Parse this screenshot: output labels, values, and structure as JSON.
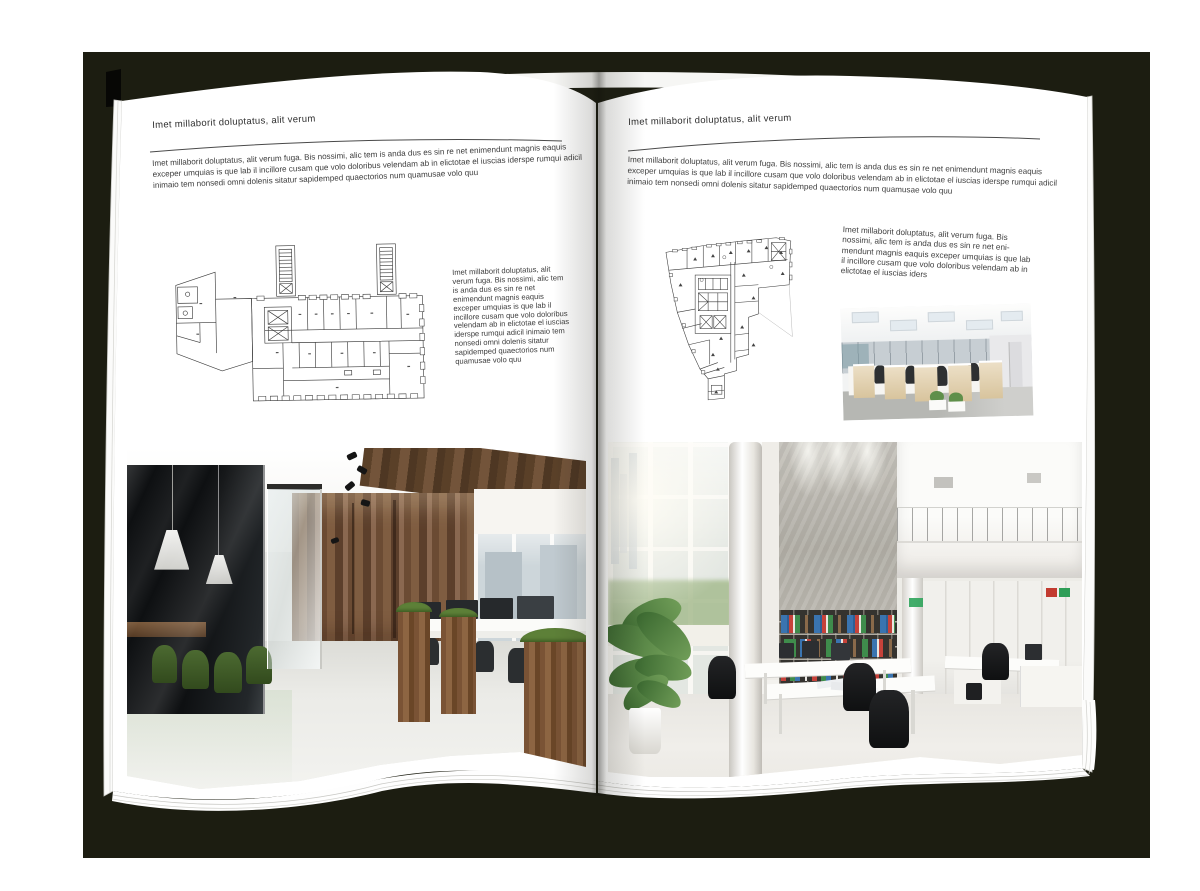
{
  "document": {
    "kind": "brochure-spread-mockup",
    "palette": {
      "backdrop": "#1c1d11",
      "page": "#ffffff",
      "text": "#3d3d3d",
      "rule": "#4a4a4a"
    }
  },
  "pages": {
    "left": {
      "header": "Imet millaborit doluptatus, alit verum",
      "intro": "Imet millaborit doluptatus, alit verum fuga. Bis nossimi, alic tem is anda dus es sin re net enimendunt magnis eaquis exceper umquias is que lab il incillore cusam que volo doloribus velendam ab in elictotae el iuscias iderspe rumqui adicil inimaio tem nonsedi omni dolenis sitatur sapidemped quaectorios num quamusae volo quu",
      "side_text": "Imet millaborit doluptatus, alit verum fuga. Bis nossimi, alic tem is anda dus es sin re net enimendunt magnis eaquis exceper umquias is que lab il incillore cusam que volo doloribus velendam ab in elictotae el iuscias iderspe rumqui adicil inimaio tem nonsedi omni dolenis sitatur sapidemped quaectorios num quamusae volo quu"
    },
    "right": {
      "header": "Imet millaborit doluptatus, alit verum",
      "intro": "Imet millaborit doluptatus, alit verum fuga. Bis nossimi, alic tem is anda dus es sin re net enimendunt magnis eaquis exceper umquias is que lab il incillore cusam que volo doloribus velendam ab in elictotae el iuscias iderspe rumqui adicil inimaio tem nonsedi omni dolenis sitatur sapidemped quaectorios num quamusae volo quu",
      "side_text": "Imet millaborit doluptatus, alit verum fuga. Bis nossimi, alic tem is anda dus es sin re net eni-mendunt magnis eaquis exceper umquias is que lab il incillore cusam que volo doloribus velendam ab in elictotae el iuscias iders"
    }
  }
}
